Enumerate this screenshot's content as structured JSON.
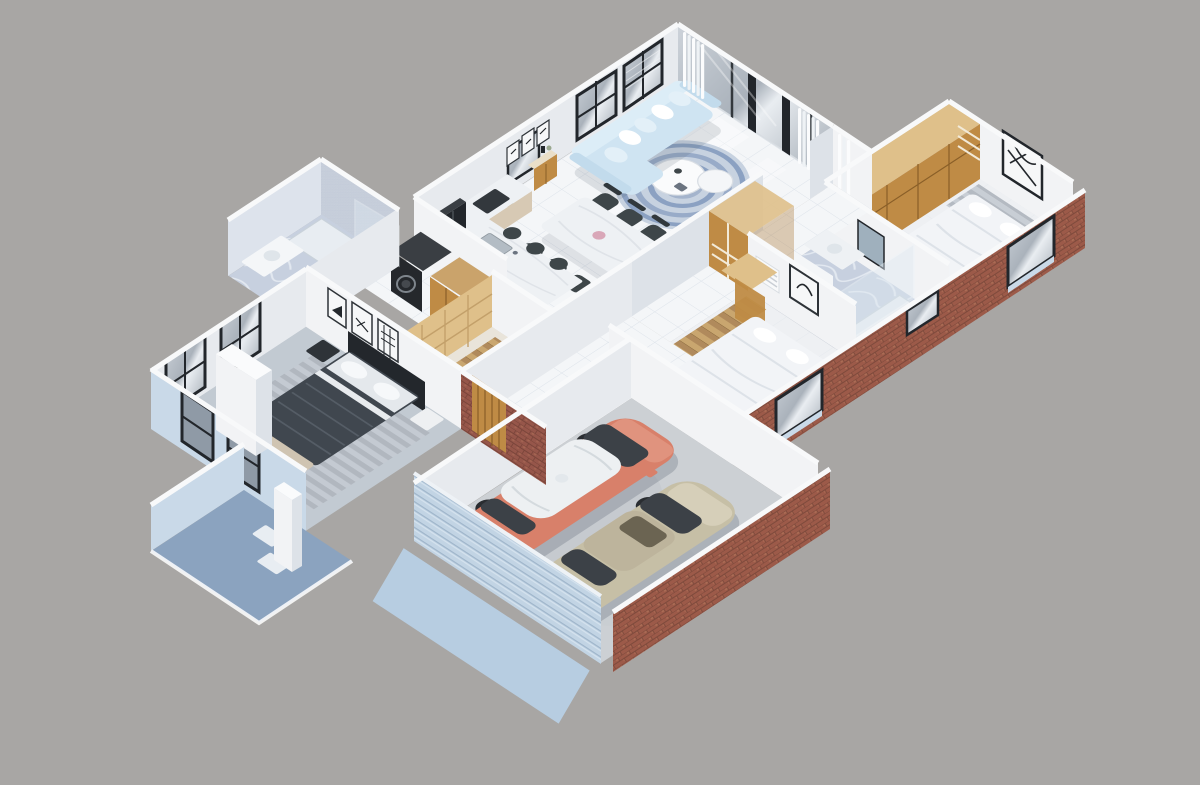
{
  "scene": {
    "description": "isometric 3D cutaway floor-plan render of a single-story house with attached two-car garage",
    "view": "isometric-cutaway",
    "background": "#a8a6a4"
  },
  "palette": {
    "bg": "#a8a6a4",
    "wallWhite": "#f2f3f5",
    "wallShade": "#e7eaee",
    "wallShade2": "#dde2e8",
    "wallTop": "#f8f9fa",
    "brick": "#9c5a49",
    "brickDark": "#7e4a3c",
    "brickLight": "#b07259",
    "blueExterior": "#c9d9e8",
    "blueDriveway": "#b7cde1",
    "bluePorch": "#8ba3bf",
    "glass": "#b6bcc4",
    "glassDark": "#3c4147",
    "frameDark": "#22262b",
    "floorTile": "#f4f6f8",
    "grout": "#dde3ea",
    "marble": "#eef1f4",
    "marbleBlue": "#c7d0df",
    "wood": "#bf8b45",
    "woodDark": "#a87635",
    "woodLight": "#dfc08a",
    "sofa": "#cfe4f2",
    "pillow": "#e3f0f8",
    "rug": "#8ba1c2",
    "rugBg": "#c7d2e0",
    "chairDark": "#3e4649",
    "cream": "#ece8df",
    "carpet": "#c2cad2",
    "bedDark": "#40474f",
    "headboard": "#23272c",
    "bedWhite": "#f2f4f7",
    "concrete": "#ccd0d4",
    "suv": "#d8806a",
    "suvRoof": "#edf0f2",
    "sedan": "#c6bfa6",
    "taillight": "#e4574a",
    "wheel": "#2a2d31",
    "hub": "#c7cbcf",
    "shadow": "#5a6573",
    "plant": "#7d8f72"
  },
  "rooms": [
    {
      "id": "living-room",
      "contents": [
        "l-shaped-sofa",
        "throw-pillows",
        "round-rug",
        "coffee-tables",
        "armchairs",
        "sideboard",
        "wall-art-frames",
        "curtains",
        "sliding-glass-doors",
        "window-with-blinds",
        "cactus-plant"
      ]
    },
    {
      "id": "dining-area",
      "contents": [
        "marble-dining-table",
        "six-dark-chairs",
        "flower-vase"
      ]
    },
    {
      "id": "kitchen",
      "contents": [
        "marble-island",
        "sink",
        "bar-stools",
        "back-counter",
        "cooktop",
        "refrigerator"
      ]
    },
    {
      "id": "laundry",
      "contents": [
        "washer",
        "dryer",
        "wood-cabinet"
      ]
    },
    {
      "id": "hallway",
      "contents": [
        "linen-closet"
      ]
    },
    {
      "id": "entry",
      "contents": [
        "wood-front-door",
        "brick-facade"
      ]
    },
    {
      "id": "master-bedroom",
      "contents": [
        "dark-double-bed",
        "white-pillows",
        "nightstands",
        "three-wall-art-frames",
        "tall-windows",
        "foot-bench",
        "gray-rug",
        "pouf"
      ]
    },
    {
      "id": "master-bathroom",
      "contents": [
        "glass-shower",
        "vanity",
        "toilet"
      ]
    },
    {
      "id": "walk-in-closet",
      "contents": [
        "wood-wardrobes",
        "striped-runner"
      ]
    },
    {
      "id": "bedroom-2",
      "contents": [
        "white-bed",
        "wood-wardrobe",
        "abstract-wall-art",
        "window-with-blue-sill"
      ]
    },
    {
      "id": "bathroom-2",
      "contents": [
        "glass-shower",
        "vanity",
        "mirror",
        "high-window"
      ]
    },
    {
      "id": "bedroom-3",
      "contents": [
        "white-bed",
        "wood-wardrobe",
        "wall-art",
        "louver-vent",
        "striped-runner",
        "window-with-blue-sill"
      ]
    },
    {
      "id": "garage",
      "contents": [
        "salmon-suv",
        "beige-sedan",
        "slatted-garage-door",
        "brick-walls"
      ]
    },
    {
      "id": "porch",
      "contents": [
        "white-column",
        "chimney-block",
        "doormats",
        "blue-floor"
      ]
    },
    {
      "id": "driveway",
      "contents": [
        "light-blue-apron"
      ]
    }
  ],
  "vehicles": {
    "suv": {
      "id": "salmon-suv",
      "bodyColor": "#d8806a",
      "roofColor": "#edf0f2"
    },
    "sedan": {
      "id": "beige-sedan",
      "bodyColor": "#c6bfa6",
      "glassColor": "#3c4147"
    }
  }
}
